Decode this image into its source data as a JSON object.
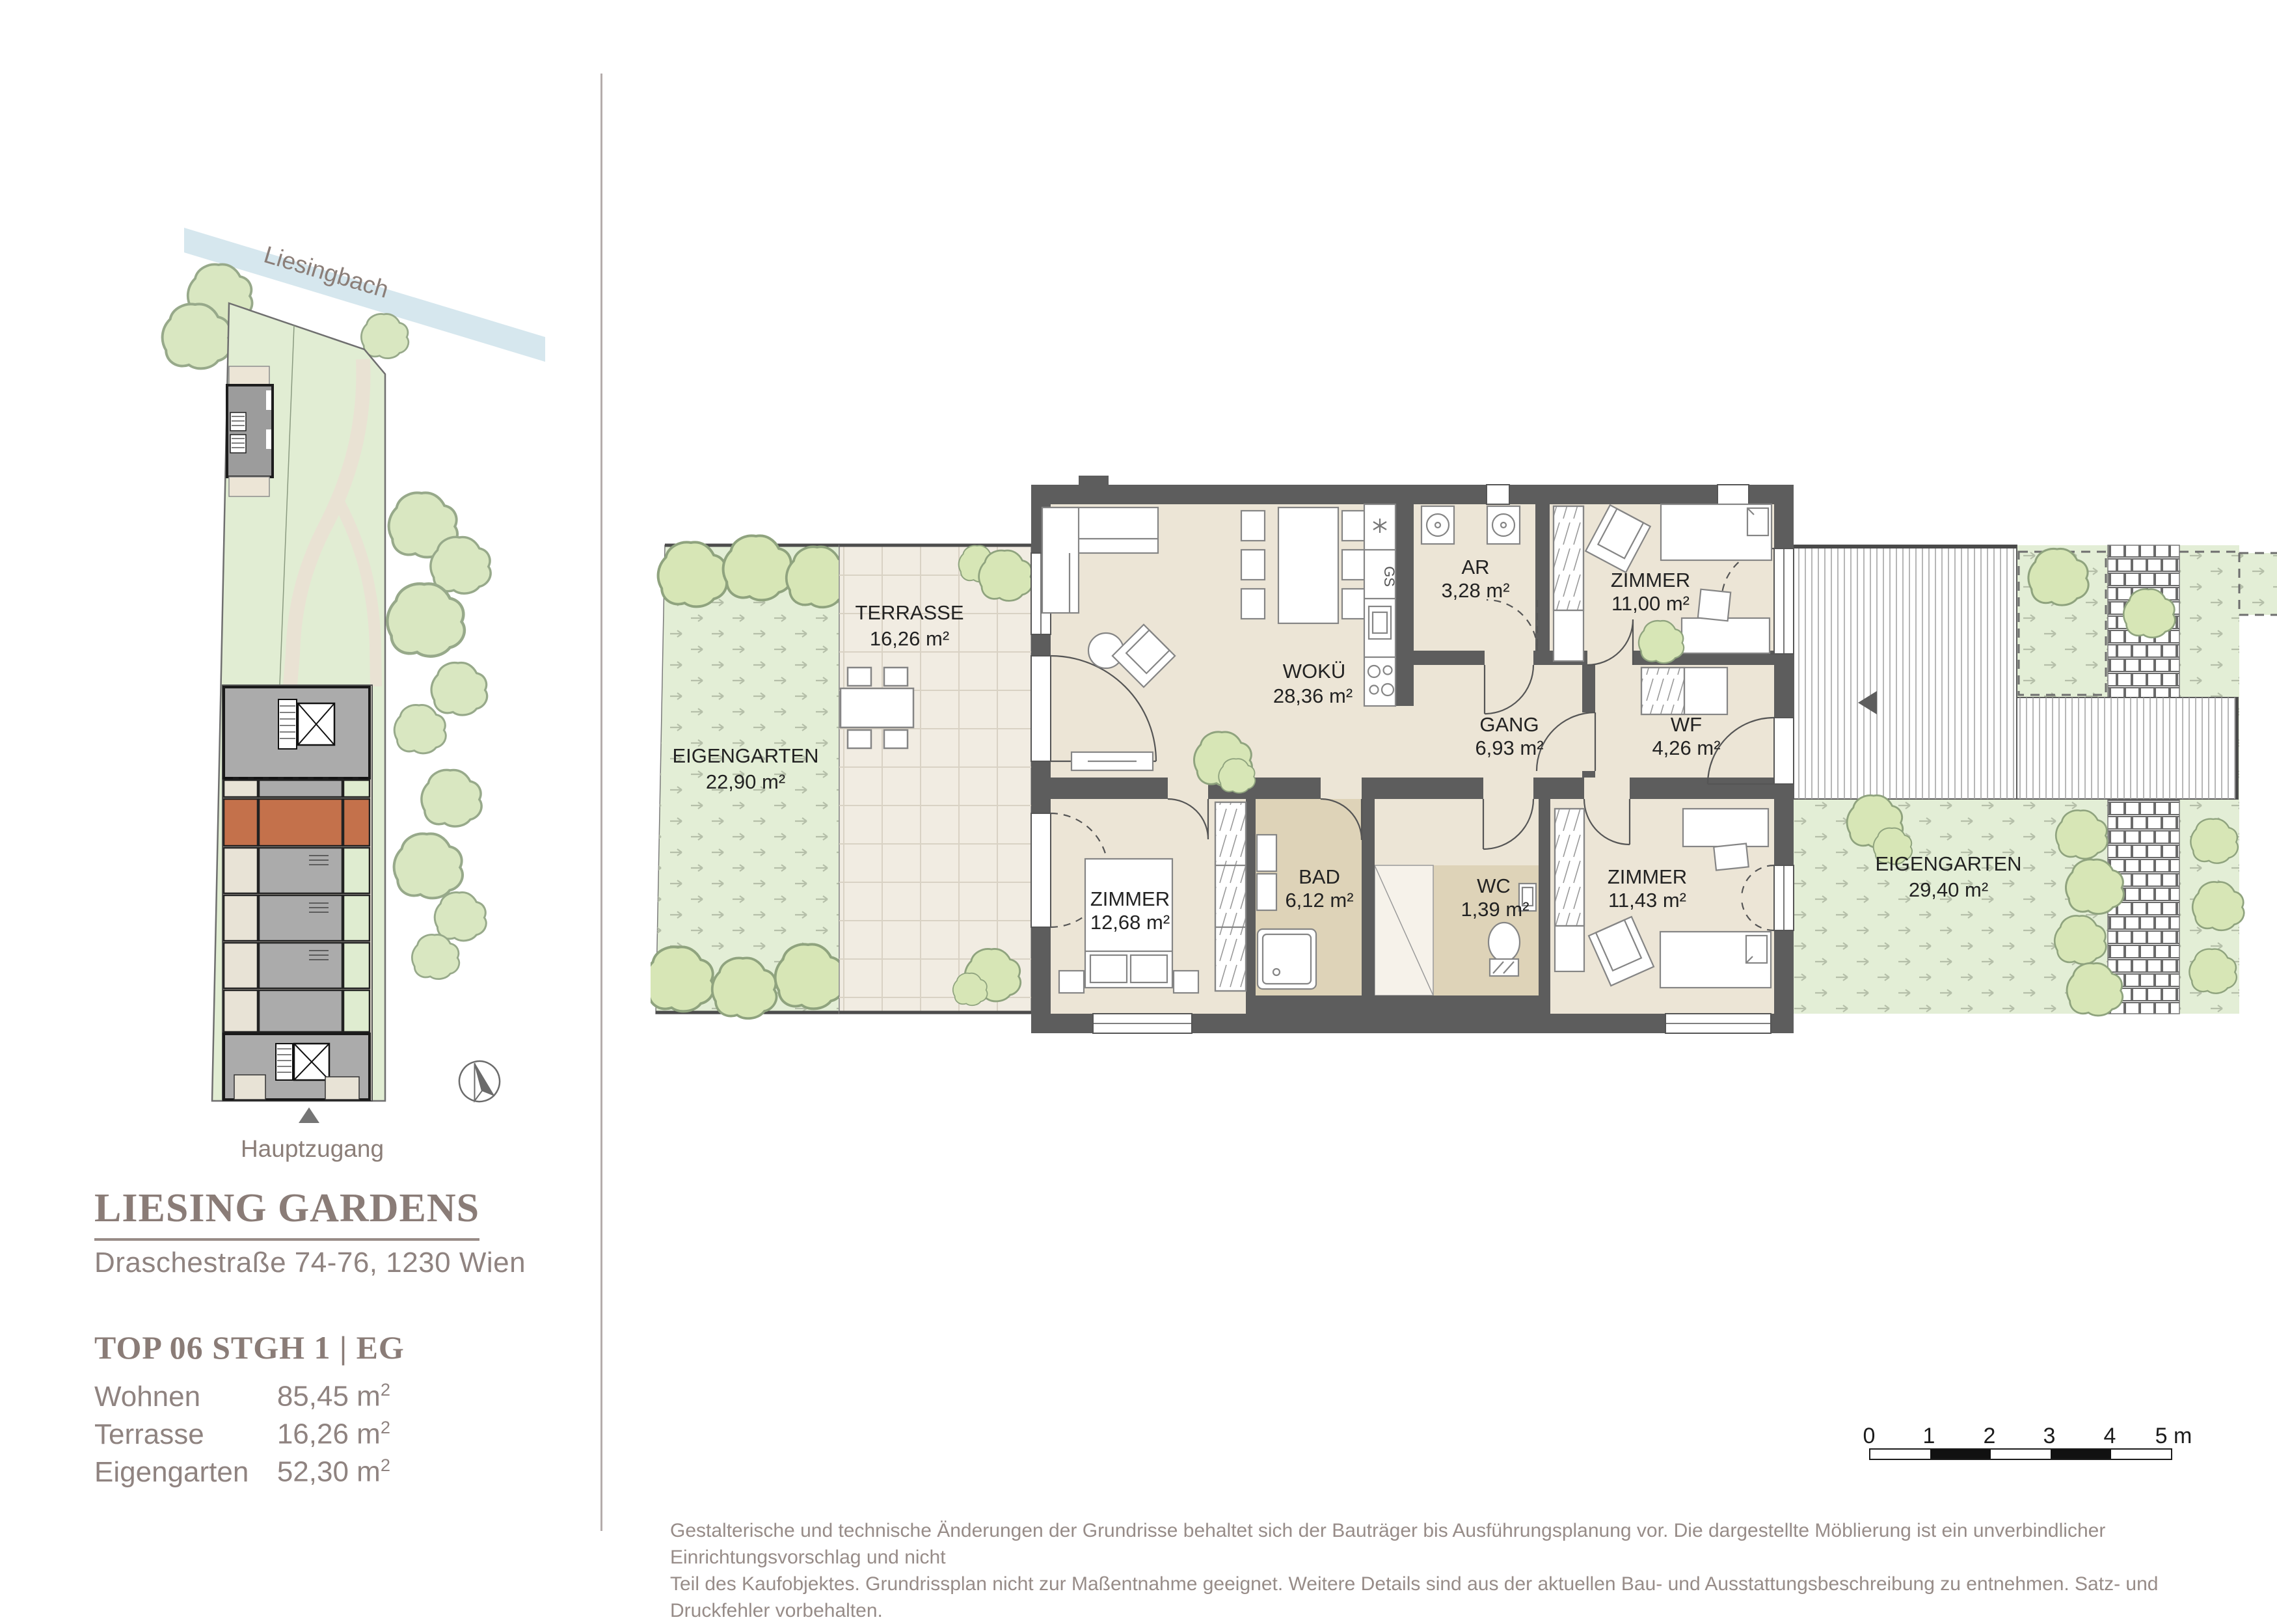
{
  "palette": {
    "accent_unit_orange": "#c4714b",
    "wall_gray": "#5d5d5d",
    "floor_beige": "#ece5d6",
    "bath_floor": "#ded3b8",
    "garden_green": "#e3eed6",
    "bush_green": "#d7e6b6",
    "water_blue": "#d6e7ee",
    "text_brown": "#8a7c77"
  },
  "sidebar": {
    "site_plan": {
      "stream_label": "Liesingbach",
      "entrance_label": "Hauptzugang"
    },
    "title": "LIESING GARDENS",
    "address": "Draschestraße 74-76, 1230 Wien",
    "unit_line": "TOP 06 STGH 1 | EG",
    "areas": [
      {
        "label": "Wohnen",
        "value": "85,45",
        "unit": "m",
        "sup": "2"
      },
      {
        "label": "Terrasse",
        "value": "16,26",
        "unit": "m",
        "sup": "2"
      },
      {
        "label": "Eigengarten",
        "value": "52,30",
        "unit": "m",
        "sup": "2"
      }
    ]
  },
  "floor_plan": {
    "rooms": [
      {
        "name": "EIGENGARTEN",
        "area": "22,90 m²"
      },
      {
        "name": "TERRASSE",
        "area": "16,26 m²"
      },
      {
        "name": "WOKÜ",
        "area": "28,36 m²"
      },
      {
        "name": "AR",
        "area": "3,28 m²"
      },
      {
        "name": "ZIMMER",
        "area": "11,00 m²"
      },
      {
        "name": "GANG",
        "area": "6,93 m²"
      },
      {
        "name": "WF",
        "area": "4,26 m²"
      },
      {
        "name": "ZIMMER",
        "area": "12,68 m²"
      },
      {
        "name": "BAD",
        "area": "6,12 m²"
      },
      {
        "name": "WC",
        "area": "1,39 m²"
      },
      {
        "name": "ZIMMER",
        "area": "11,43 m²"
      },
      {
        "name": "EIGENGARTEN",
        "area": "29,40 m²"
      }
    ],
    "kitchen": {
      "dishwasher_label": "GS"
    }
  },
  "scale_bar": {
    "ticks": [
      "0",
      "1",
      "2",
      "3",
      "4",
      "5 m"
    ]
  },
  "disclaimer": {
    "line1": "Gestalterische und technische Änderungen der Grundrisse behaltet sich der Bauträger bis Ausführungsplanung vor. Die dargestellte Möblierung ist ein unverbindlicher Einrichtungsvorschlag und nicht",
    "line2": "Teil des Kaufobjektes. Grundrissplan nicht zur Maßentnahme geeignet. Weitere Details sind aus der aktuellen Bau- und Ausstattungsbeschreibung zu entnehmen. Satz- und Druckfehler vorbehalten."
  }
}
